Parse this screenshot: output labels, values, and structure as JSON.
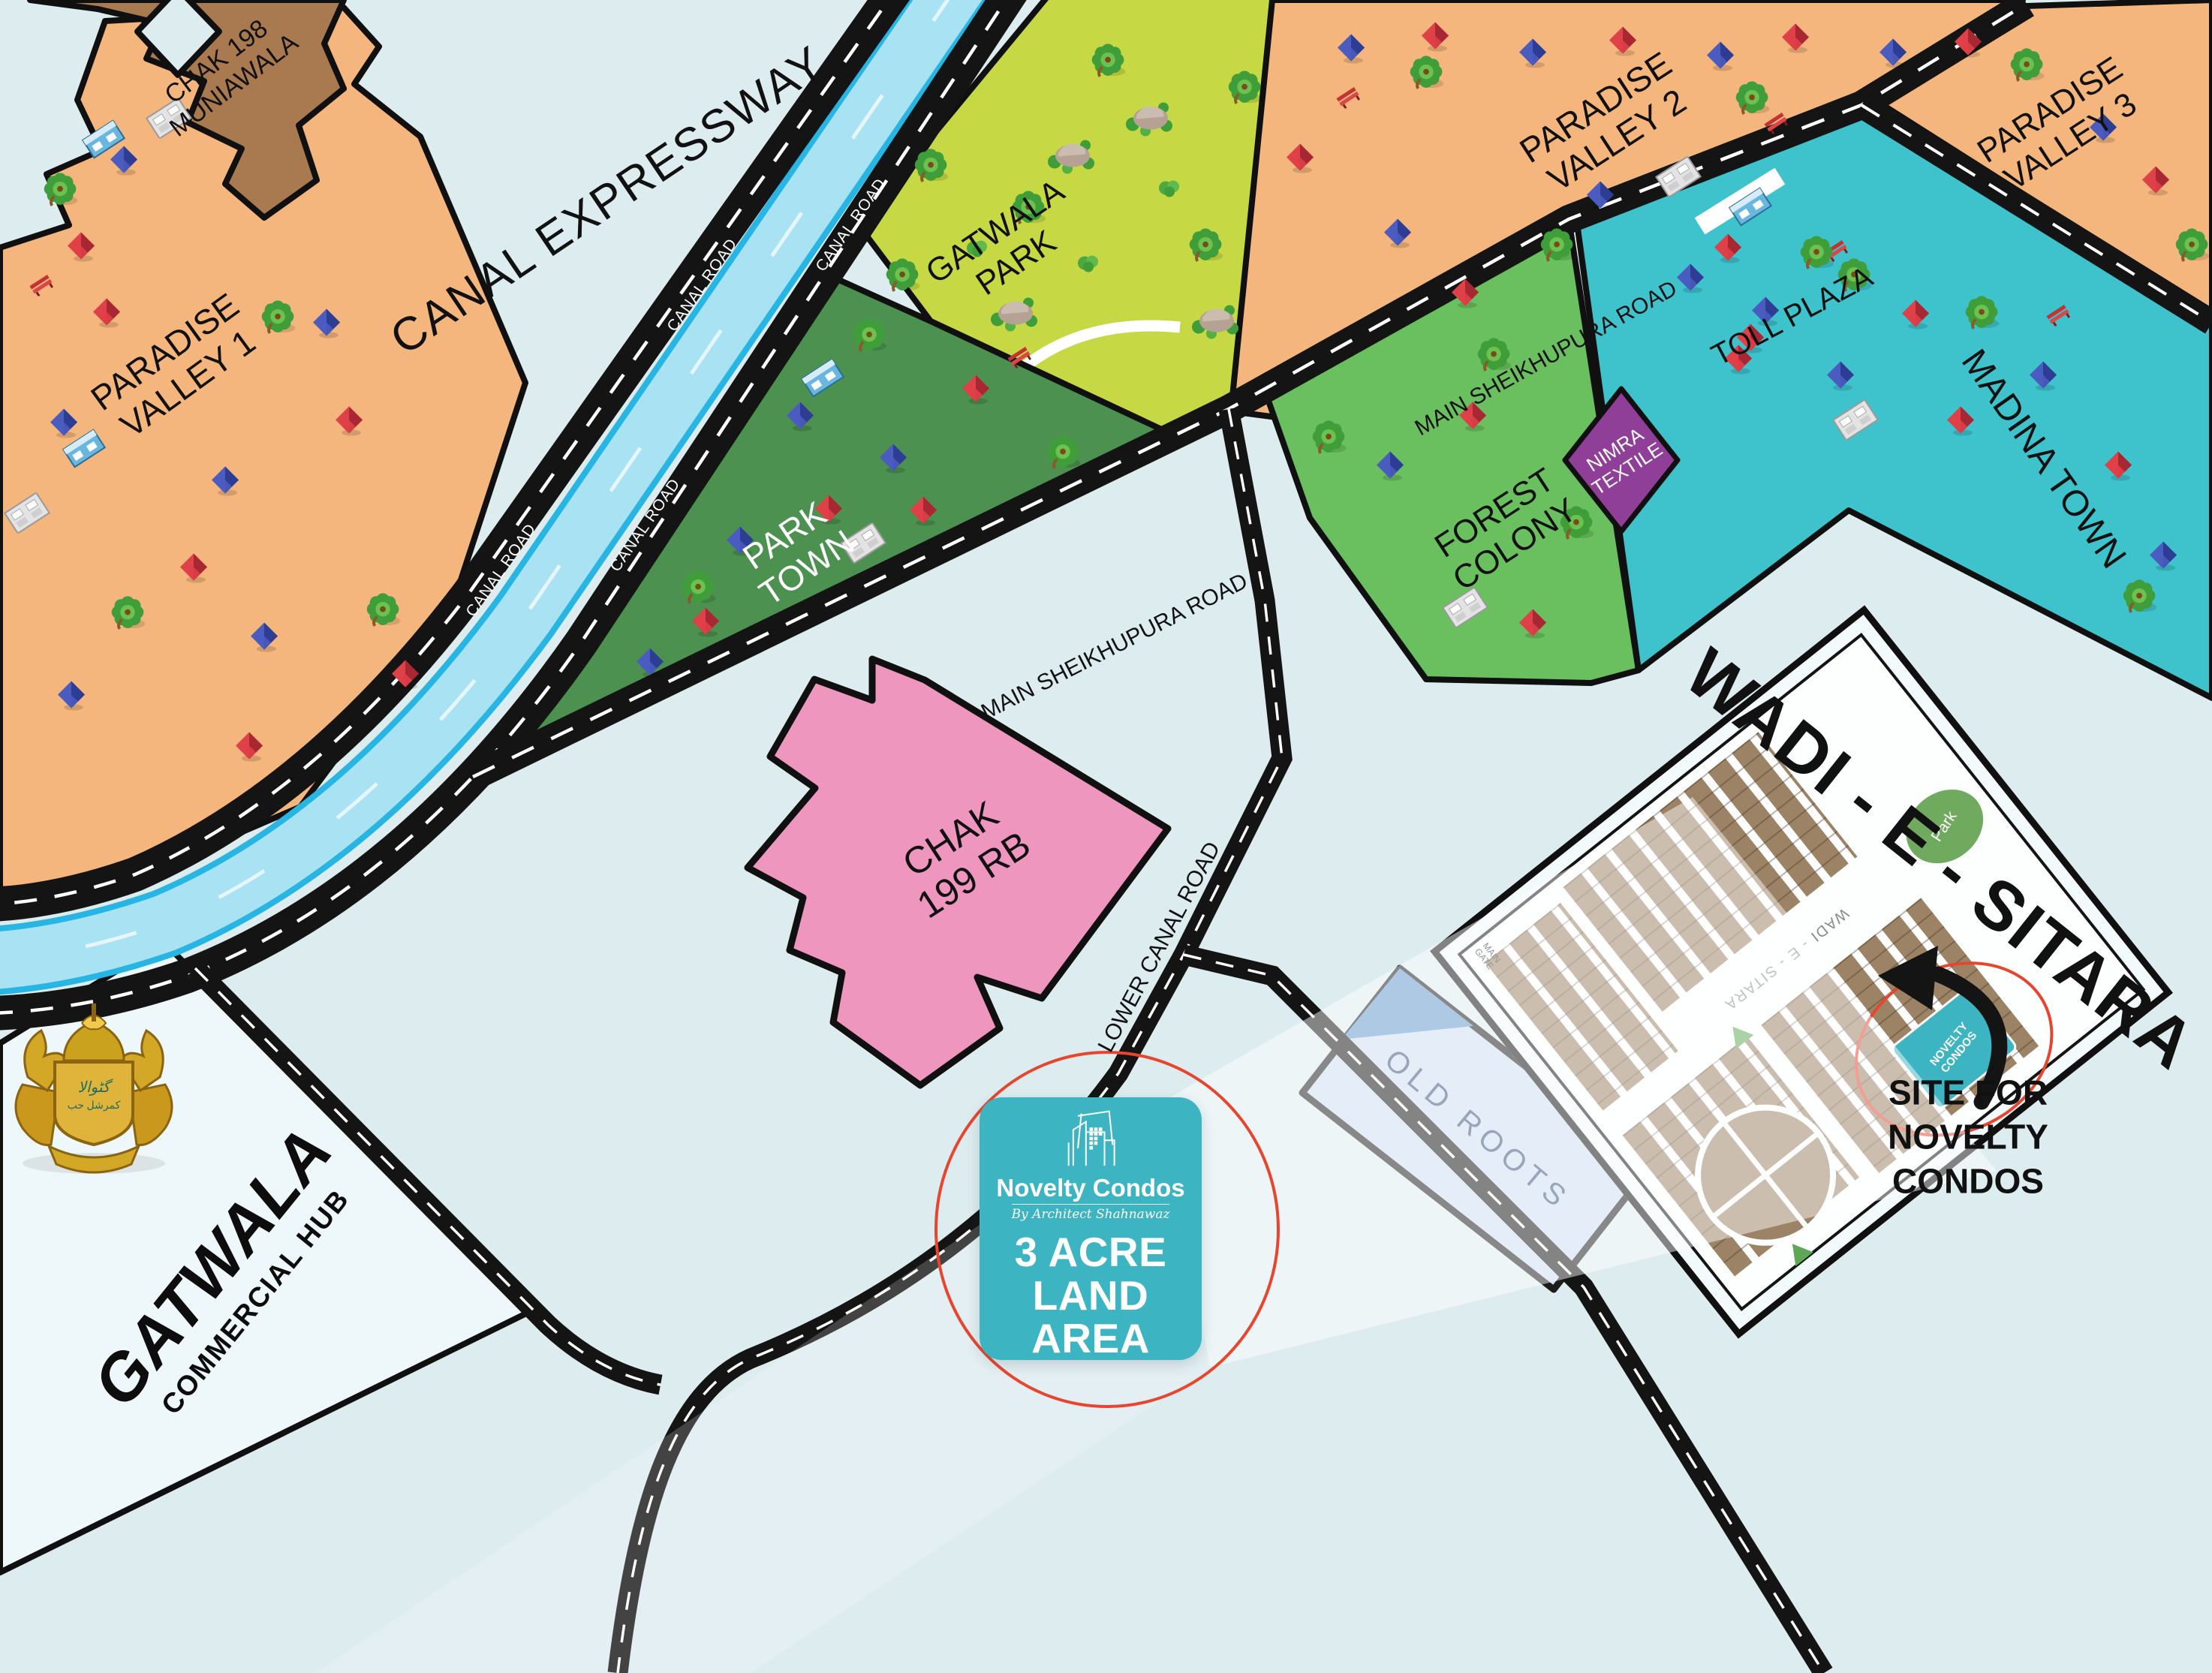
{
  "map": {
    "background": "#ddecef",
    "colors": {
      "paradise_orange": "#f4b67c",
      "chak198_brown": "#a9794f",
      "gatwala_park_green": "#c6d944",
      "park_town_green": "#4c9150",
      "forest_green": "#6abf5e",
      "madina_teal": "#3ec3cd",
      "nimra_purple": "#8f3f98",
      "chak199_pink": "#ee96be",
      "canal_water": "#a9e2f3",
      "canal_edge": "#27b6e4",
      "road_black": "#141414",
      "wadi_plots_brown": "#9c8366",
      "novelty_teal": "#3db4c2",
      "highlight_red": "#e8452f",
      "old_roots_blue": "#cddff2"
    },
    "labels": {
      "chak198": "CHAK 198\nMUNIAWALA",
      "pv1": "PARADISE\nVALLEY 1",
      "pv2": "PARADISE\nVALLEY 2",
      "pv3": "PARADISE\nVALLEY 3",
      "canal_expressway": "CANAL EXPRESSWAY",
      "canal_road": "CANAL ROAD",
      "gatwala_park": "GATWALA\nPARK",
      "park_town": "PARK\nTOWN",
      "main_sheikhupura": "MAIN SHEIKHUPURA ROAD",
      "toll_plaza": "TOLL PLAZA",
      "madina_town": "MADINA TOWN",
      "nimra": "NIMRA\nTEXTILE",
      "forest": "FOREST\nCOLONY",
      "chak199": "CHAK\n199 RB",
      "lower_canal": "LOWER CANAL ROAD",
      "old_roots": "OLD ROOTS",
      "site_callout": "SITE FOR\nNOVELTY CONDOS"
    },
    "wadi": {
      "title": "WADI - E - SITARA",
      "road": "WADI - E - SITARA",
      "main_gate": "MAIN\nGATE",
      "park": "Park",
      "site": "NOVELTY\nCONDOS"
    },
    "hub": {
      "name": "GATWALA",
      "subtitle": "COMMERCIAL HUB"
    },
    "badge": {
      "brand": "Novelty Condos",
      "byline": "By Architect Shahnawaz",
      "headline": "3 ACRE\nLAND AREA"
    },
    "decorations": [
      [
        "tree",
        82,
        258
      ],
      [
        "tree",
        372,
        428
      ],
      [
        "tree",
        512,
        818
      ],
      [
        "tree",
        172,
        822
      ],
      [
        "house",
        165,
        215,
        "b"
      ],
      [
        "house",
        108,
        330,
        "r"
      ],
      [
        "house",
        142,
        418,
        "r"
      ],
      [
        "house",
        85,
        565,
        "b"
      ],
      [
        "house",
        435,
        432,
        "b"
      ],
      [
        "house",
        465,
        562,
        "r"
      ],
      [
        "house",
        300,
        642,
        "b"
      ],
      [
        "house",
        258,
        758,
        "r"
      ],
      [
        "house",
        352,
        850,
        "b"
      ],
      [
        "house",
        332,
        996,
        "r"
      ],
      [
        "house",
        95,
        928,
        "b"
      ],
      [
        "house",
        540,
        900,
        "r"
      ],
      [
        "bench",
        55,
        382
      ],
      [
        "school",
        225,
        160,
        "gray"
      ],
      [
        "school",
        138,
        188,
        "blue"
      ],
      [
        "school",
        36,
        686,
        "gray"
      ],
      [
        "school",
        112,
        600,
        "blue"
      ],
      [
        "rock",
        1428,
        208
      ],
      [
        "rock",
        1532,
        158
      ],
      [
        "rock",
        1352,
        418
      ],
      [
        "rock",
        1620,
        428
      ],
      [
        "tree",
        1478,
        86
      ],
      [
        "tree",
        1242,
        226
      ],
      [
        "tree",
        1372,
        282
      ],
      [
        "tree",
        1660,
        122
      ],
      [
        "tree",
        1204,
        372
      ],
      [
        "tree",
        1608,
        332
      ],
      [
        "bush",
        1558,
        252
      ],
      [
        "bush",
        1302,
        332
      ],
      [
        "bush",
        1450,
        352
      ],
      [
        "school",
        1096,
        506,
        "blue"
      ],
      [
        "bench",
        1358,
        478
      ],
      [
        "tree",
        1160,
        452
      ],
      [
        "tree",
        1418,
        608
      ],
      [
        "tree",
        932,
        788
      ],
      [
        "house",
        1300,
        520,
        "r"
      ],
      [
        "house",
        1190,
        612,
        "b"
      ],
      [
        "house",
        1104,
        680,
        "r"
      ],
      [
        "house",
        986,
        722,
        "b"
      ],
      [
        "house",
        940,
        830,
        "r"
      ],
      [
        "house",
        1066,
        556,
        "b"
      ],
      [
        "house",
        1230,
        682,
        "r"
      ],
      [
        "house",
        866,
        884,
        "b"
      ],
      [
        "school",
        1150,
        726,
        "gray"
      ],
      [
        "house",
        1800,
        66,
        "b"
      ],
      [
        "house",
        1912,
        50,
        "r"
      ],
      [
        "house",
        2042,
        72,
        "b"
      ],
      [
        "house",
        2162,
        56,
        "r"
      ],
      [
        "house",
        2292,
        76,
        "b"
      ],
      [
        "house",
        2392,
        52,
        "r"
      ],
      [
        "house",
        2522,
        72,
        "b"
      ],
      [
        "house",
        2622,
        58,
        "r"
      ],
      [
        "house",
        1732,
        212,
        "r"
      ],
      [
        "house",
        1862,
        312,
        "b"
      ],
      [
        "house",
        1952,
        392,
        "r"
      ],
      [
        "house",
        2132,
        262,
        "b"
      ],
      [
        "house",
        2302,
        332,
        "r"
      ],
      [
        "bench",
        1796,
        132
      ],
      [
        "bench",
        2366,
        166
      ],
      [
        "tree",
        1902,
        102
      ],
      [
        "tree",
        2336,
        136
      ],
      [
        "tree",
        2076,
        332
      ],
      [
        "tree",
        1992,
        478
      ],
      [
        "school",
        2236,
        238,
        "gray"
      ],
      [
        "bench",
        2446,
        336
      ],
      [
        "tree",
        2472,
        372
      ],
      [
        "house",
        2352,
        416,
        "b"
      ],
      [
        "house",
        2316,
        480,
        "r"
      ],
      [
        "house",
        2802,
        172,
        "b"
      ],
      [
        "house",
        2872,
        242,
        "r"
      ],
      [
        "tree",
        2702,
        92
      ],
      [
        "tree",
        2922,
        332
      ],
      [
        "house",
        2252,
        372,
        "b"
      ],
      [
        "house",
        2332,
        452,
        "r"
      ],
      [
        "house",
        2452,
        502,
        "b"
      ],
      [
        "house",
        2552,
        420,
        "r"
      ],
      [
        "house",
        2612,
        562,
        "r"
      ],
      [
        "house",
        2722,
        502,
        "b"
      ],
      [
        "house",
        2822,
        622,
        "r"
      ],
      [
        "house",
        2882,
        742,
        "b"
      ],
      [
        "tree",
        2422,
        342
      ],
      [
        "tree",
        2642,
        422
      ],
      [
        "tree",
        2852,
        800
      ],
      [
        "school",
        2332,
        278,
        "blue"
      ],
      [
        "school",
        2472,
        562,
        "gray"
      ],
      [
        "bench",
        2742,
        422
      ],
      [
        "house",
        1962,
        556,
        "r"
      ],
      [
        "house",
        1852,
        622,
        "b"
      ],
      [
        "tree",
        2102,
        702
      ],
      [
        "house",
        2042,
        832,
        "r"
      ],
      [
        "school",
        1952,
        812,
        "gray"
      ],
      [
        "tree",
        1772,
        588
      ]
    ]
  }
}
